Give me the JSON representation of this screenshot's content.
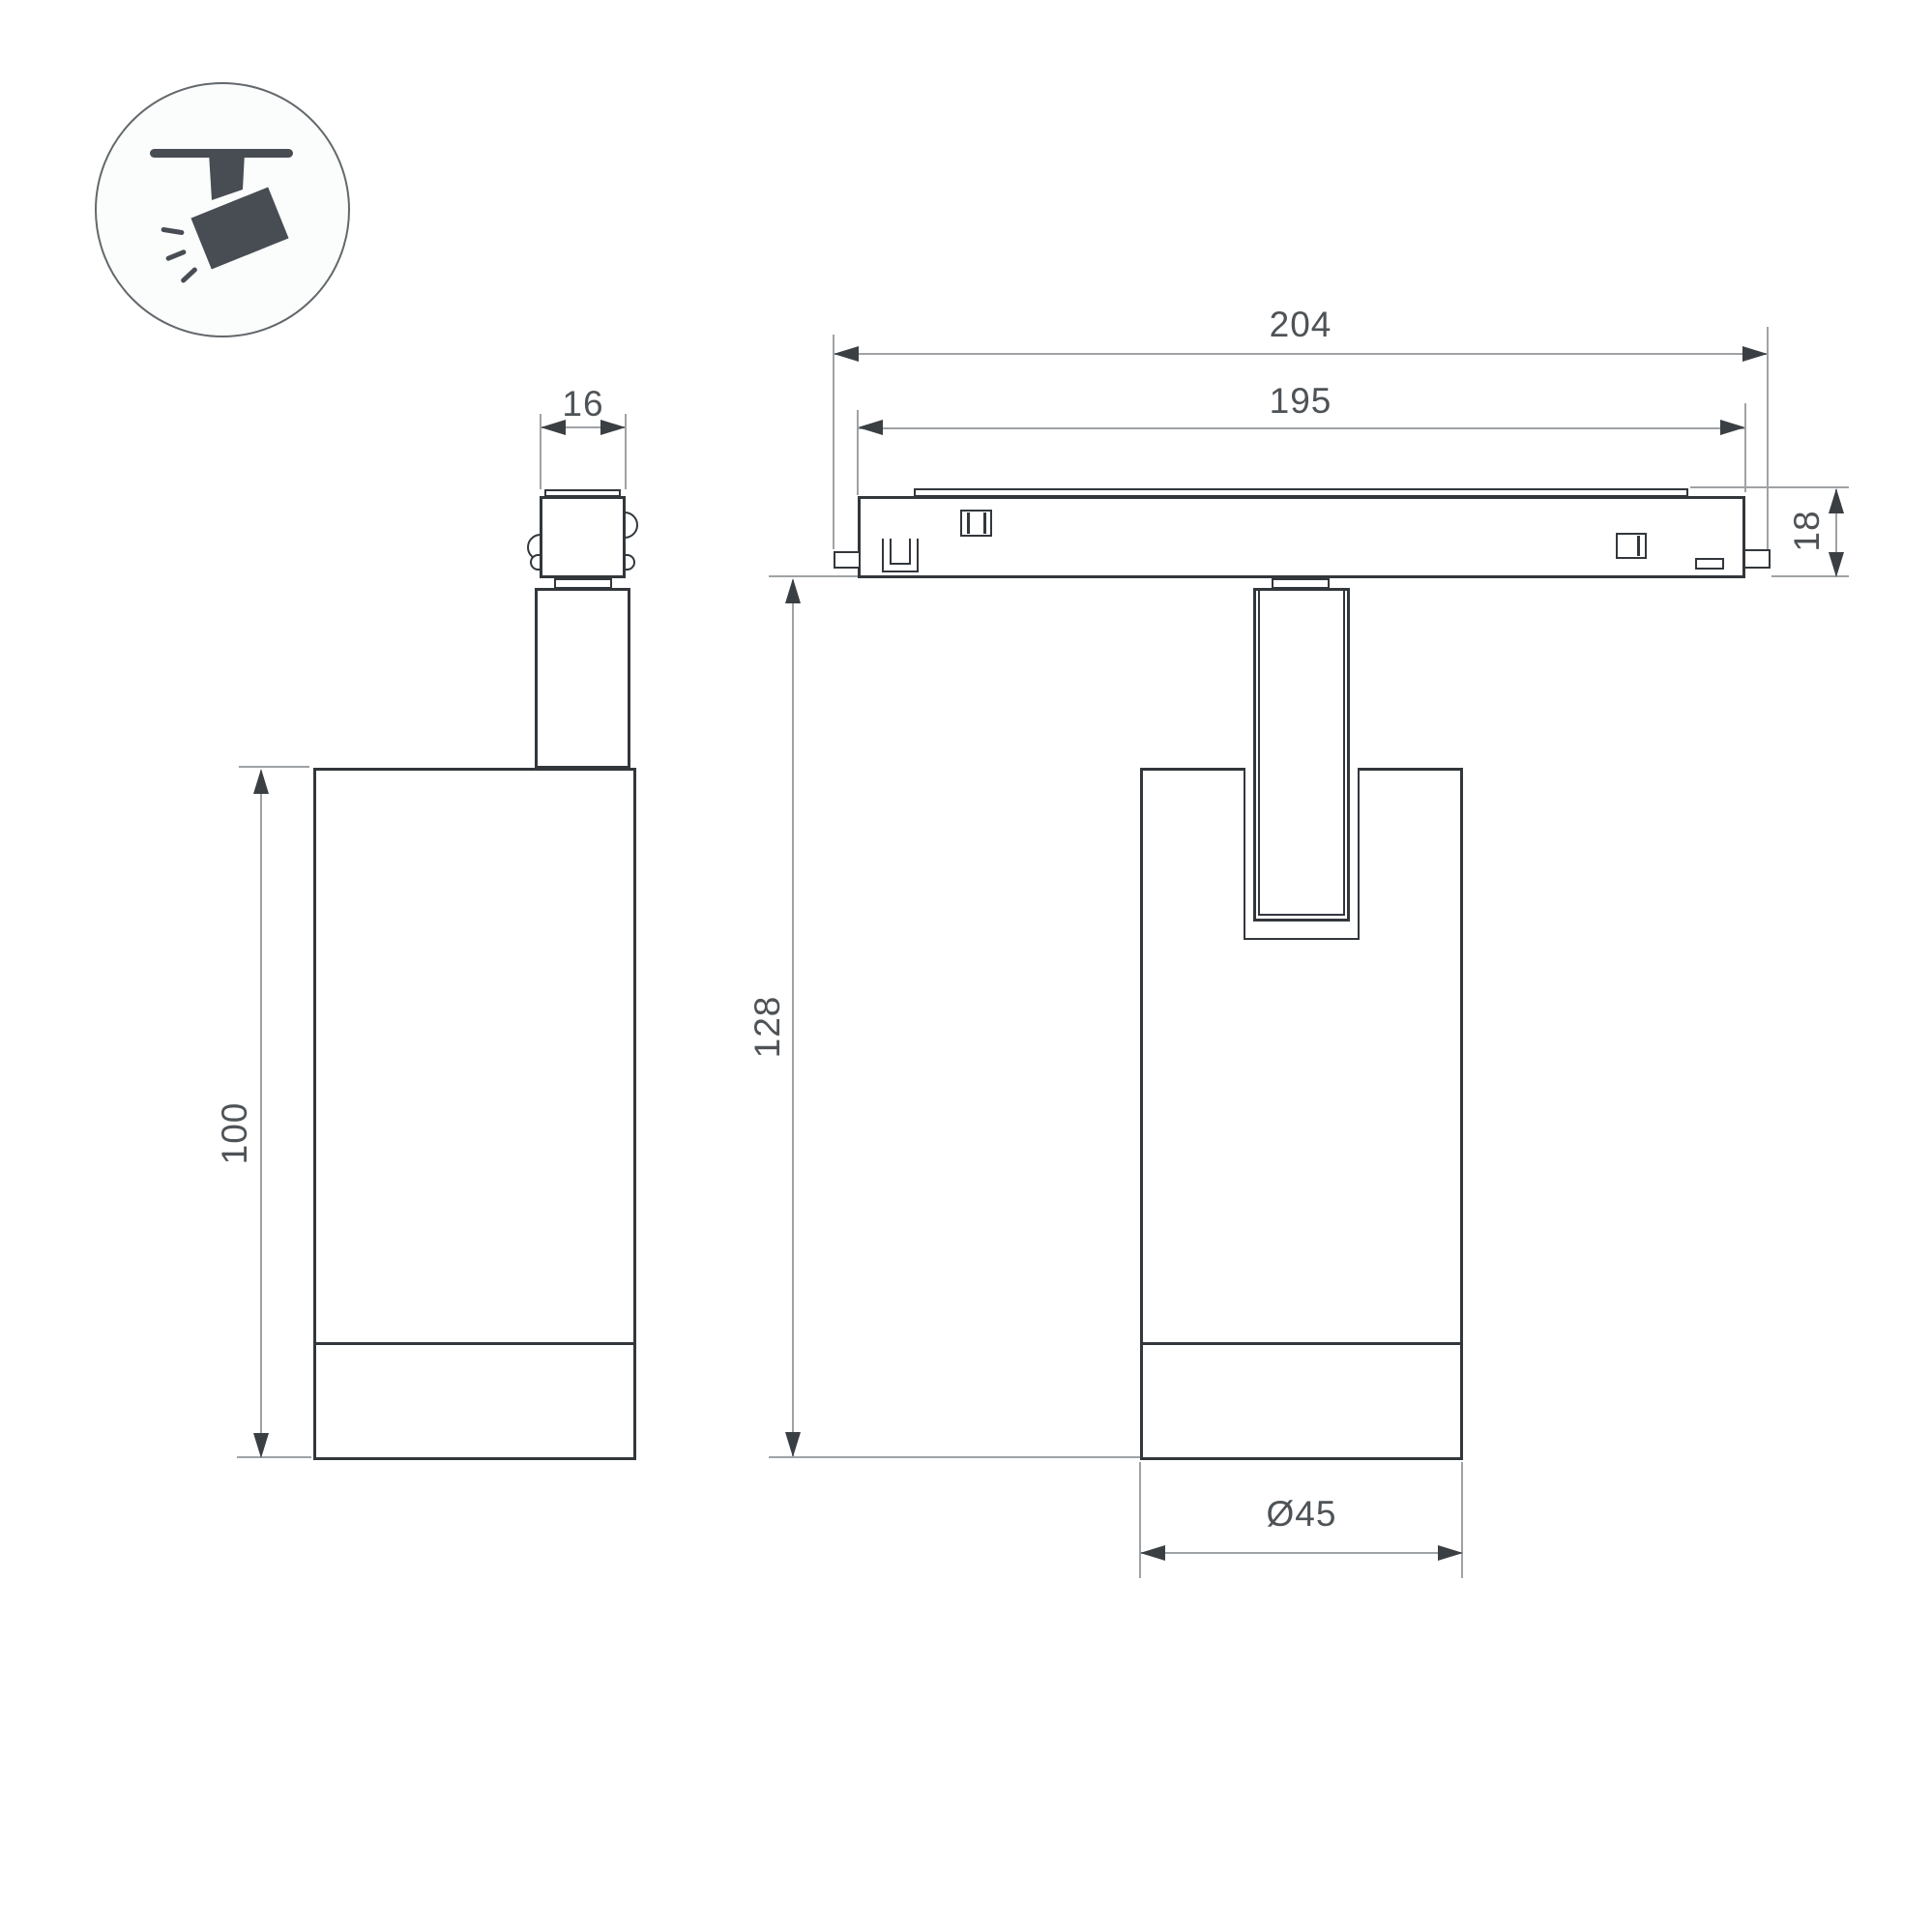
{
  "title": "Track spotlight dimension drawing",
  "icon": {
    "label": "ceiling-track spotlight pictogram"
  },
  "dimensions": {
    "adapter_width": "16",
    "track_total": "204",
    "track_body": "195",
    "track_height": "18",
    "body_height": "100",
    "overall_height": "128",
    "body_diameter": "Ø45"
  },
  "colors": {
    "outline": "#32373c",
    "thin_line": "#9fa2a5",
    "arrow": "#3a3f44",
    "dimension_text": "#4e5357",
    "icon_fill": "#474d53",
    "icon_circle_border": "#63686c",
    "background": "#ffffff"
  }
}
